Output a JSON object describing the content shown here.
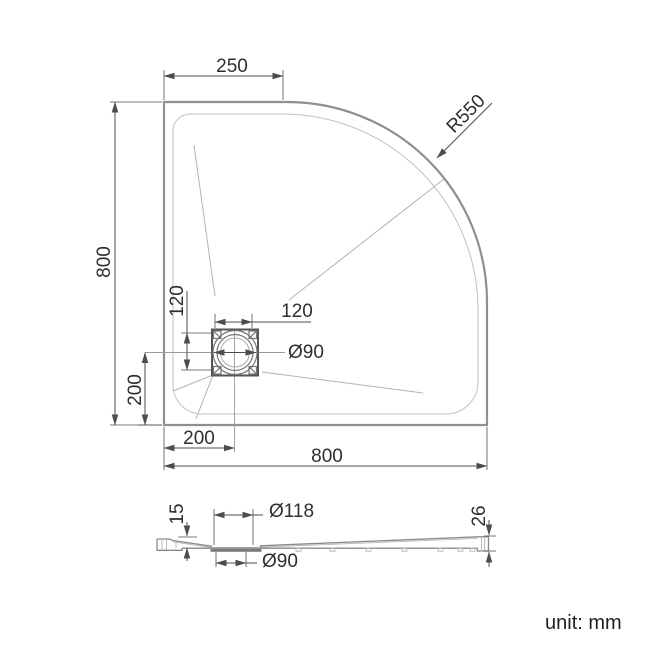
{
  "drawing_type": "technical-dimension-drawing",
  "unit_label": "unit: mm",
  "top_view": {
    "description": "quadrant shower tray plan view",
    "dims": {
      "top_straight_edge": "250",
      "overall_height": "800",
      "corner_radius": "R550",
      "drain_square_height": "120",
      "drain_square_width": "120",
      "drain_diameter": "Ø90",
      "drain_offset_bottom": "200",
      "drain_offset_left": "200",
      "overall_width": "800"
    }
  },
  "section_view": {
    "description": "tray cross-section profile",
    "dims": {
      "drain_end_height": "15",
      "recess_diameter": "Ø118",
      "waste_hole_diameter": "Ø90",
      "outer_edge_height": "26"
    }
  },
  "colors": {
    "background": "#ffffff",
    "outline": "#8f8f8f",
    "dim": "#4d4d4d",
    "text": "#2e2e2e"
  }
}
